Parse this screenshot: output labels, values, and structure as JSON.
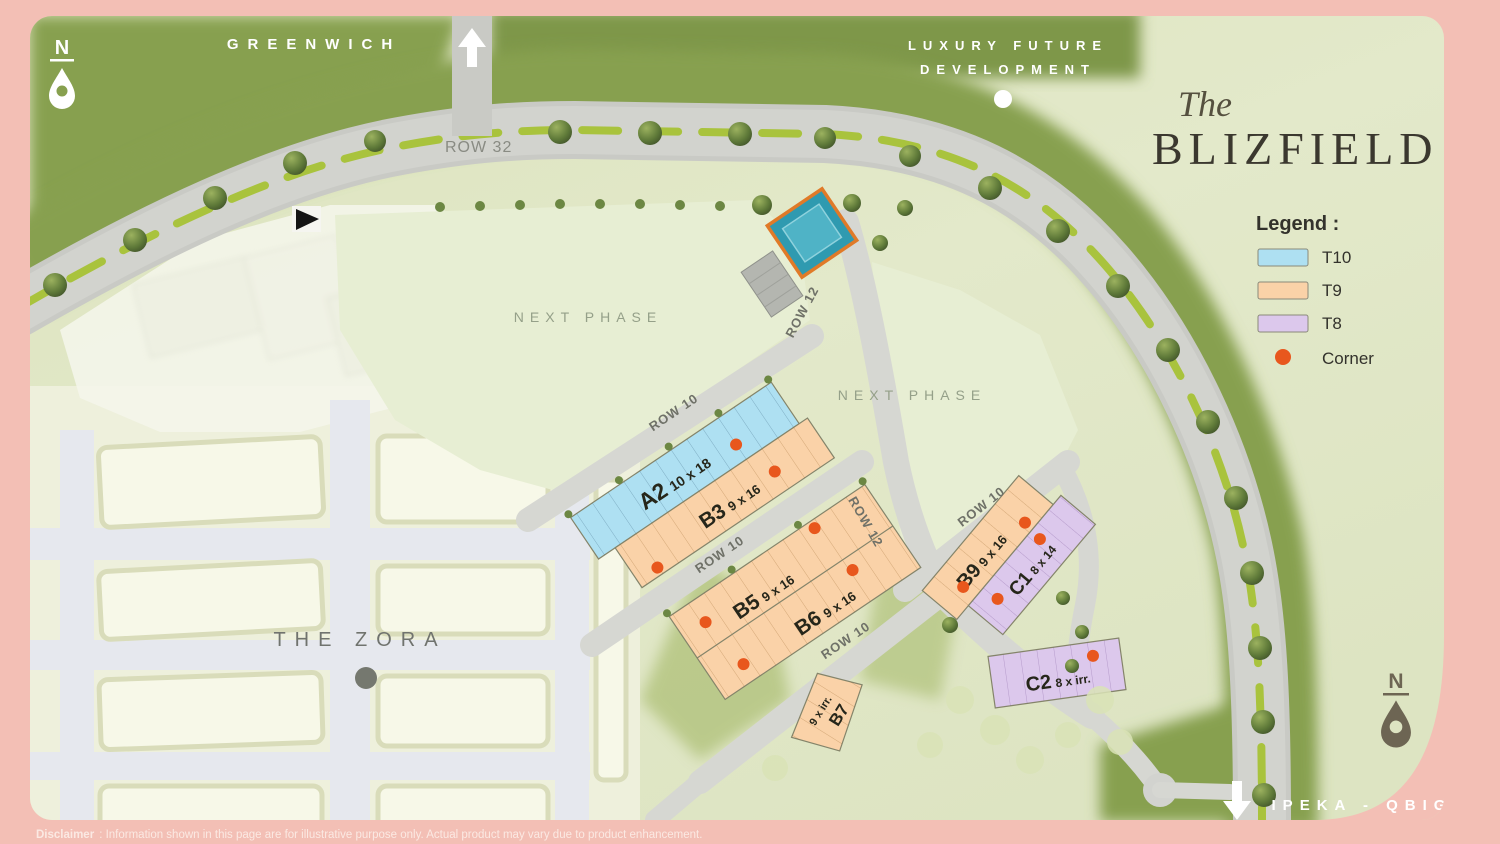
{
  "title": {
    "pre": "The",
    "main": "BLIZFIELD"
  },
  "legend": {
    "heading": "Legend :",
    "items": [
      {
        "label": "T10",
        "color": "#aee0f2"
      },
      {
        "label": "T9",
        "color": "#fad2a8"
      },
      {
        "label": "T8",
        "color": "#dcc8ec"
      },
      {
        "label": "Corner",
        "color": "#e8571d"
      }
    ]
  },
  "roads": {
    "row32": "ROW 32",
    "row10": "ROW 10",
    "row12": "ROW 12"
  },
  "landmarks": {
    "greenwich": "GREENWICH",
    "luxury_line1": "LUXURY FUTURE",
    "luxury_line2": "DEVELOPMENT",
    "next_phase": "NEXT PHASE",
    "the_zora": "THE ZORA",
    "ipeka": "IPEKA - QBIG",
    "north": "N"
  },
  "blocks": [
    {
      "id": "A2",
      "size": "10 x 18",
      "type": "T10"
    },
    {
      "id": "B3",
      "size": "9 x 16",
      "type": "T9"
    },
    {
      "id": "B5",
      "size": "9 x 16",
      "type": "T9"
    },
    {
      "id": "B6",
      "size": "9 x 16",
      "type": "T9"
    },
    {
      "id": "B7",
      "size": "9 x irr.",
      "type": "T9"
    },
    {
      "id": "B9",
      "size": "9 x 16",
      "type": "T9"
    },
    {
      "id": "C1",
      "size": "8 x 14",
      "type": "T8"
    },
    {
      "id": "C2",
      "size": "8 x irr.",
      "type": "T8"
    }
  ],
  "disclaimer": {
    "label": "Disclaimer",
    "text": ": Information shown in this page are for illustrative purpose only. Actual product may vary due to product enhancement."
  }
}
